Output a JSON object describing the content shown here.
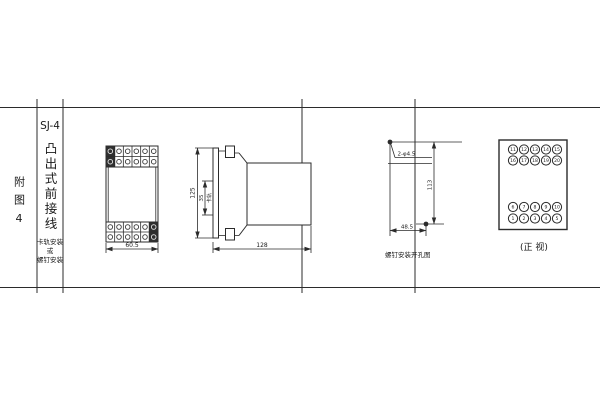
{
  "page": {
    "background": "#ffffff",
    "line_color": "#2b2b2b"
  },
  "index_column": {
    "label": "附图4"
  },
  "title_block": {
    "model": "SJ-4",
    "type_vertical": "凸出式前接线",
    "mount_note": [
      "卡轨安装",
      "或",
      "螺钉安装"
    ]
  },
  "front_view": {
    "width_dim": "60.5"
  },
  "side_view": {
    "height_dim": "125",
    "rail_width_dim": "35",
    "rail_label": "卡轨",
    "depth_dim": "128"
  },
  "drill_view": {
    "hole_label": "2-φ4.5",
    "vertical_dim": "113",
    "horizontal_dim": "48.5",
    "caption": "螺钉安装开孔图"
  },
  "terminal_view": {
    "caption": "(正 视)",
    "rows": [
      [
        "11",
        "12",
        "13",
        "14",
        "15"
      ],
      [
        "16",
        "17",
        "18",
        "19",
        "20"
      ],
      [
        "6",
        "7",
        "8",
        "9",
        "10"
      ],
      [
        "1",
        "2",
        "3",
        "4",
        "5"
      ]
    ]
  }
}
